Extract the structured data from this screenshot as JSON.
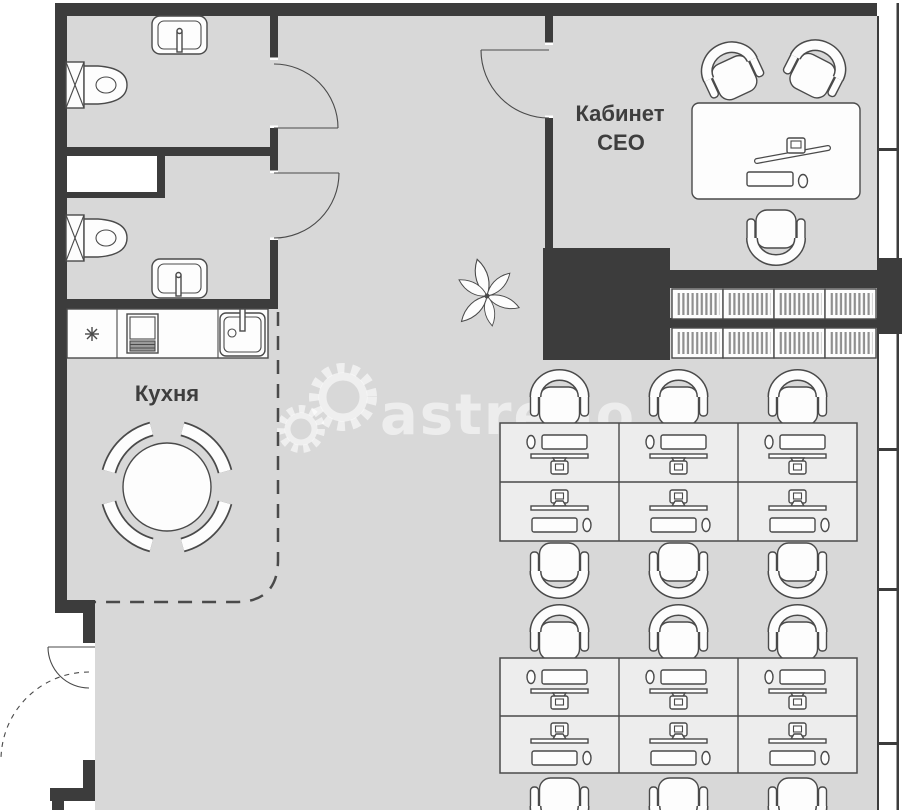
{
  "labels": {
    "ceo_office_line1": "Кабинет",
    "ceo_office_line2": "СЕО",
    "kitchen": "Кухня"
  },
  "watermark": {
    "text": "astrego"
  },
  "colors": {
    "floor": "#d8d8d8",
    "wall": "#3c3c3c",
    "furniture_line": "#4a4a4a",
    "furniture_fill": "#fdfdfd",
    "desk_bank_fill": "#ededed",
    "label_text": "#3e3e3e",
    "watermark": "#ffffff"
  }
}
